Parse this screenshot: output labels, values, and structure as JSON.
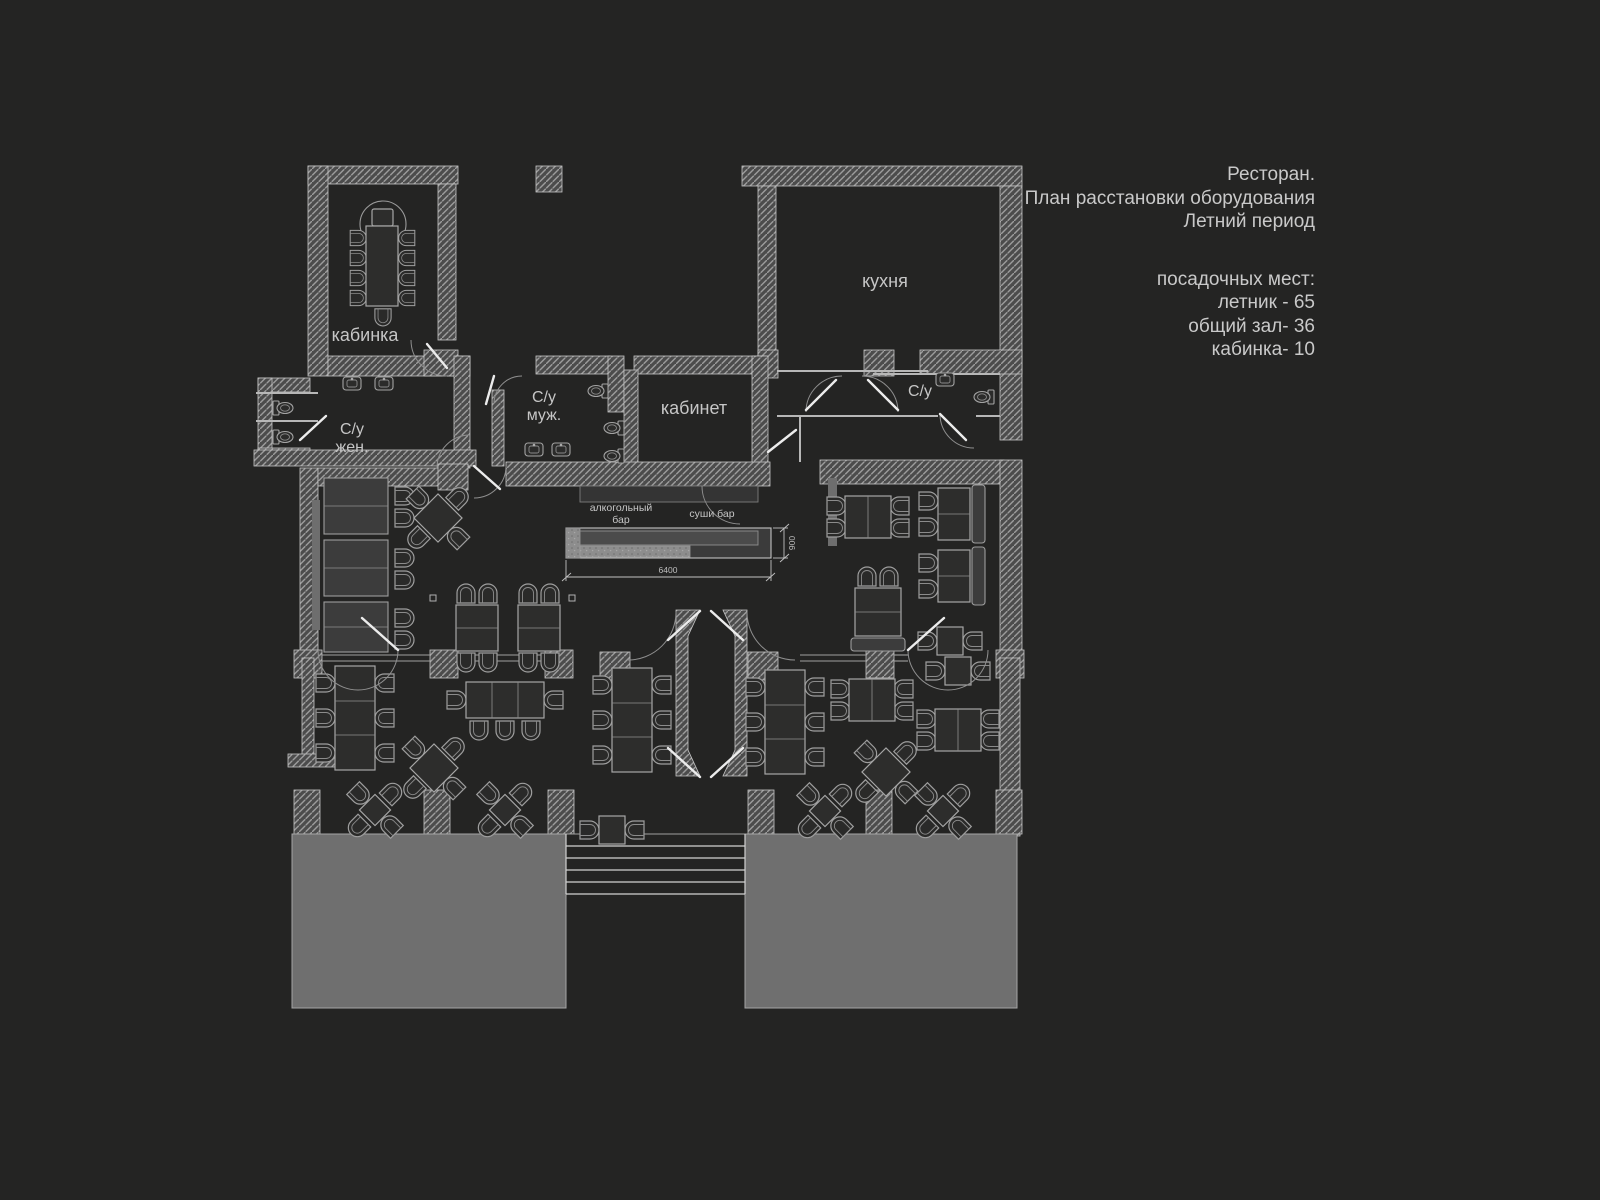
{
  "info_panel": {
    "title_lines": [
      "Ресторан.",
      "План расстановки оборудования",
      "Летний период"
    ],
    "seats_header": "посадочных мест:",
    "seats_lines": [
      "летник - 65",
      "общий зал-  36",
      "кабинка- 10"
    ]
  },
  "plan": {
    "labels": {
      "booth_room": "кабинка",
      "kitchen": "кухня",
      "wc_men_line1": "С/у",
      "wc_men_line2": "муж.",
      "wc_women_line1": "С/у",
      "wc_women_line2": "жен.",
      "wc_kitchen": "С/у",
      "office": "кабинет",
      "alcohol_bar_line1": "алкогольный",
      "alcohol_bar_line2": "бар",
      "sushi_bar": "суши бар"
    },
    "dimensions": {
      "bar_length_mm": "6400",
      "bar_depth_mm": "900"
    },
    "colors": {
      "background": "#242423",
      "wall_fill": "#4c4c4c",
      "wall_hatch_line": "#9c9c9c",
      "furniture_line": "#9e9e9e",
      "label_text": "#c6c6c6",
      "panel_text": "#c9c9c9",
      "terrace_pad": "#6f6f6f",
      "bar_counter_texture": "#8d8d8d"
    }
  }
}
